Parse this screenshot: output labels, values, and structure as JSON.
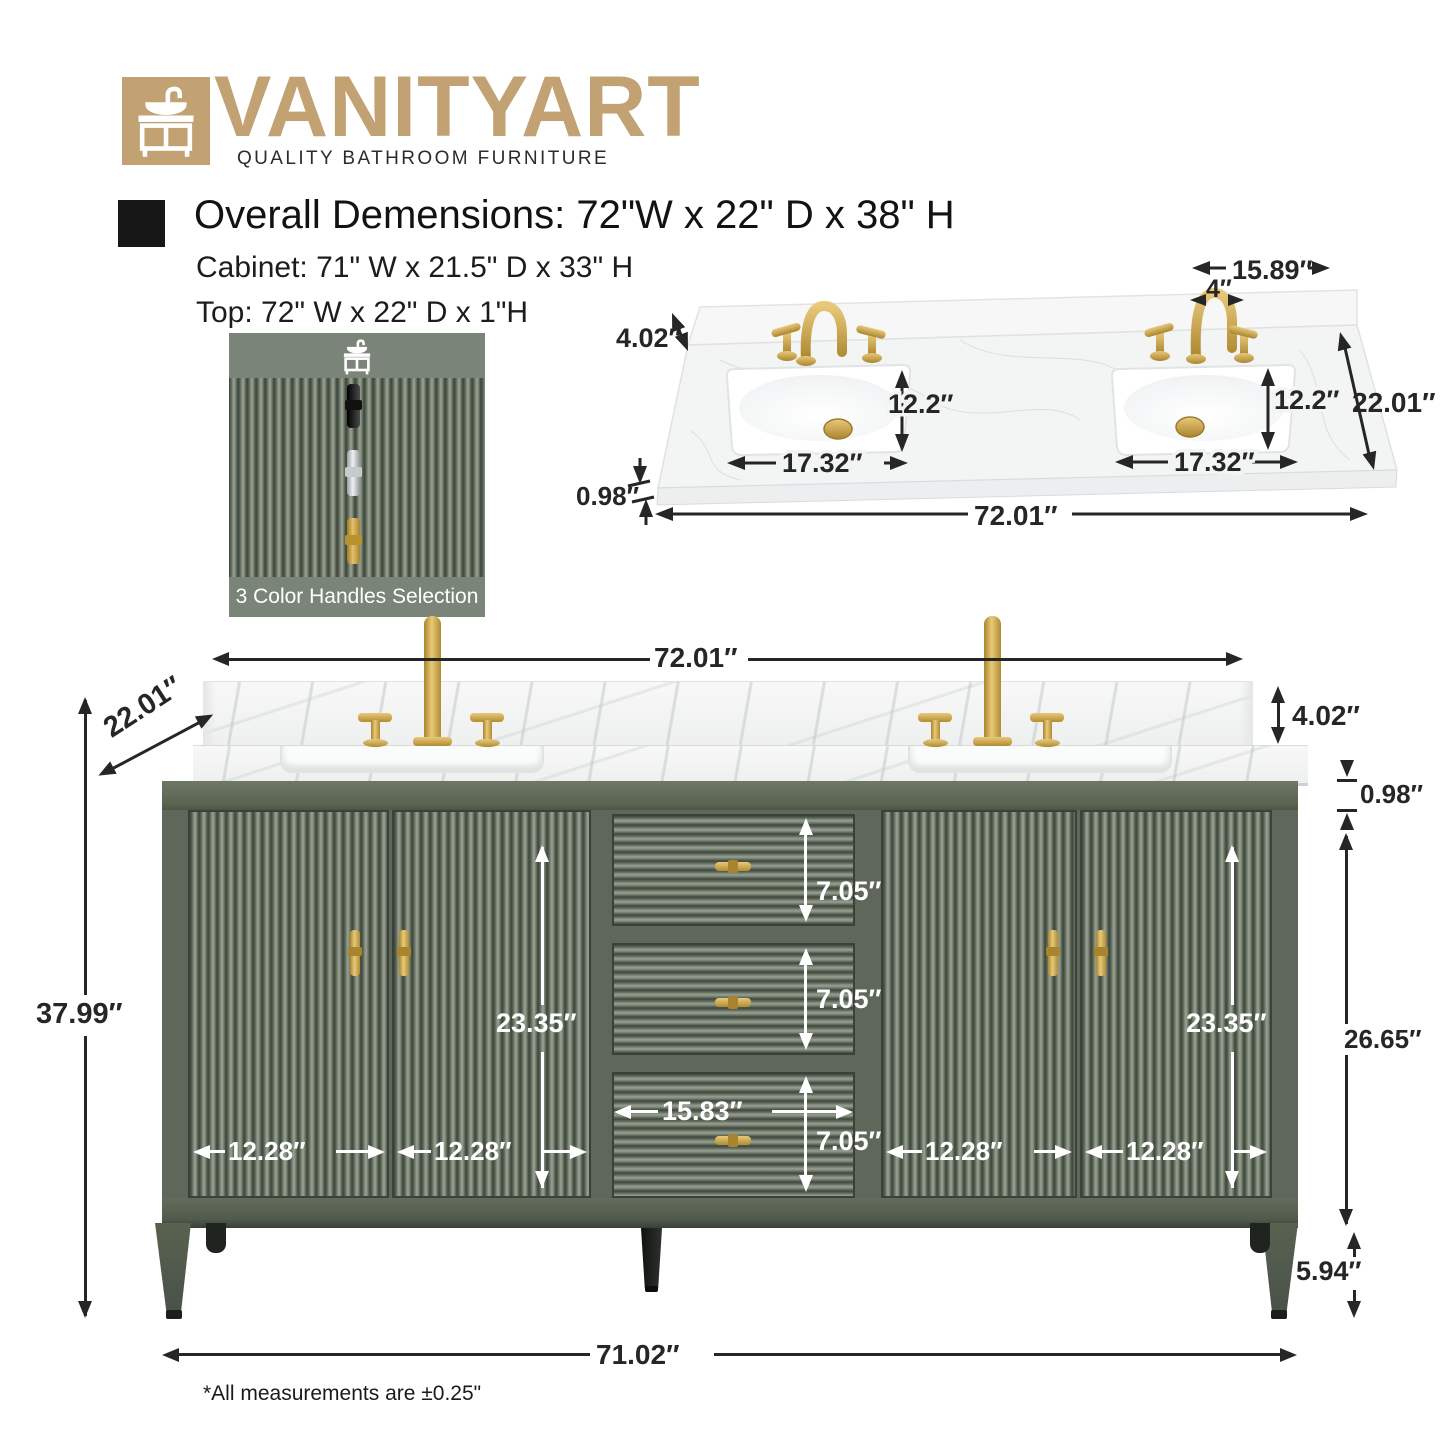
{
  "brand": {
    "name": "VANITYART",
    "tagline": "QUALITY BATHROOM FURNITURE"
  },
  "specs": {
    "overall": "Overall Demensions: 72\"W x 22\" D x 38\" H",
    "cabinet": "Cabinet: 71\" W x 21.5\" D x 33\" H",
    "top": "Top: 72\" W x 22\" D x 1\"H"
  },
  "handles_panel": {
    "caption": "3 Color Handles Selection",
    "options": [
      "black-handle",
      "chrome-handle",
      "gold-handle"
    ]
  },
  "top_view": {
    "dims": {
      "backsplash_height": "4.02″",
      "front_thickness": "0.98″",
      "total_width": "72.01″",
      "faucet_spread": "15.89″",
      "faucet_hole_spacing": "4″",
      "left_sink_depth": "12.2″",
      "left_sink_width": "17.32″",
      "right_sink_depth": "12.2″",
      "right_sink_width": "17.32″",
      "total_depth": "22.01″"
    }
  },
  "front_view": {
    "dims": {
      "top_width": "72.01″",
      "top_depth": "22.01″",
      "backsplash_height": "4.02″",
      "counter_thickness": "0.98″",
      "total_height": "37.99″",
      "left_door_height": "23.35″",
      "right_door_height": "23.35″",
      "cabinet_body_height": "26.65″",
      "drawer1_height": "7.05″",
      "drawer2_height": "7.05″",
      "drawer3_height": "7.05″",
      "drawer_width": "15.83″",
      "door1_width": "12.28″",
      "door2_width": "12.28″",
      "door3_width": "12.28″",
      "door4_width": "12.28″",
      "bottom_width": "71.02″",
      "leg_height": "5.94″"
    }
  },
  "footnote": "*All measurements are ±0.25\"",
  "colors": {
    "brand_gold": "#C2A173",
    "cabinet_green": "#5E6759",
    "hardware_gold": "#C9A24A",
    "marble_white": "#F4F5F4"
  }
}
